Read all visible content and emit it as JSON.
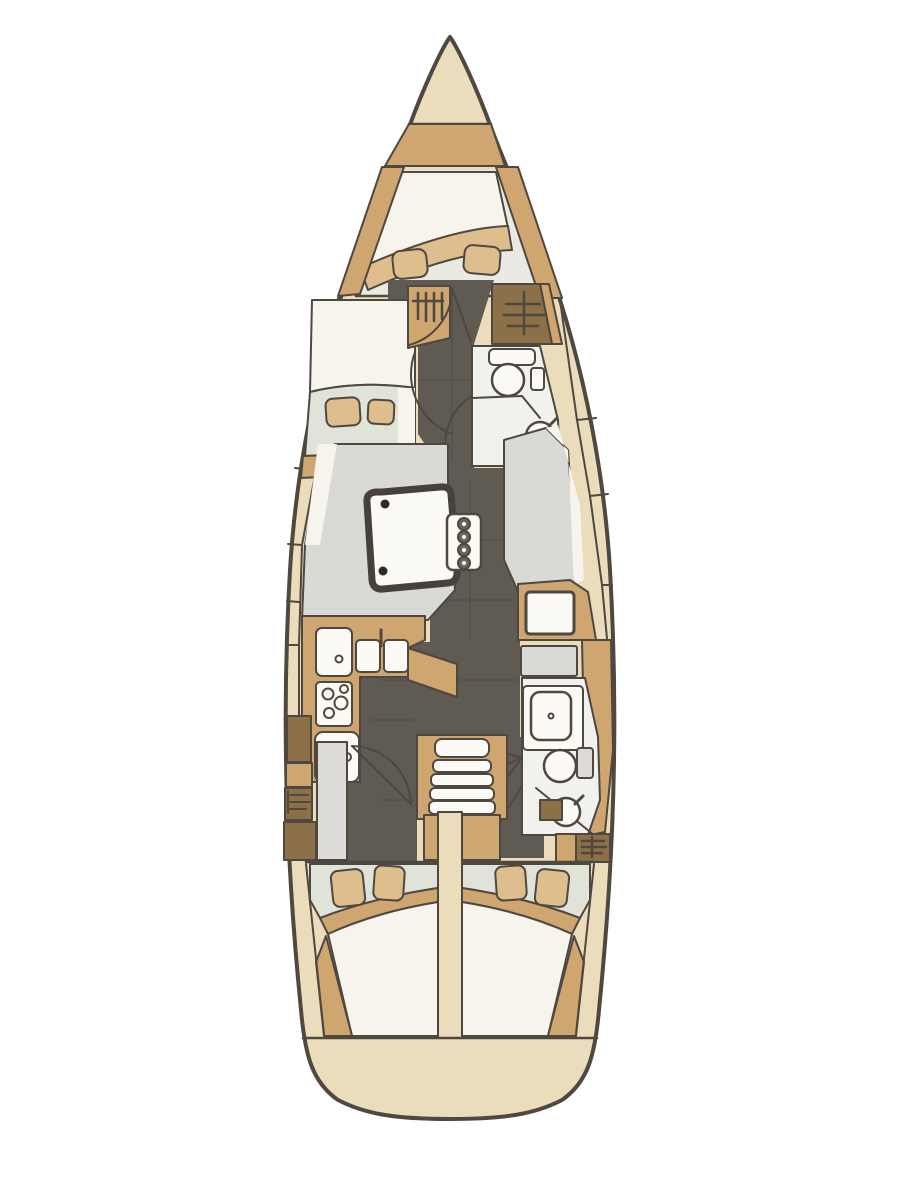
{
  "meta": {
    "app": "yacht-floor-plan",
    "description": "Top-down interior layout plan of a sailing yacht with bow V-berth cabin, forward port cabin, two heads, saloon with table, L-shaped galley, navigation station, companionway stairs and two mirrored aft double cabins",
    "canvas": {
      "width": 900,
      "height": 1200
    }
  },
  "colors": {
    "background": "#ffffff",
    "outline": "#4e4840",
    "table_border": "#46423b",
    "tile_line": "#2f2b26",
    "hull_cream": "#ebdcbc",
    "wood": "#cfa670",
    "wood_light": "#dfbe8d",
    "wood_dark": "#8c7048",
    "floor_dark": "#5f5a52",
    "floor_light": "#d9d9d5",
    "pale_green": "#e0e3d7",
    "cabin_floor": "#e8eae3",
    "berth_white": "#f6f4ec",
    "room_white": "#f1f1ed",
    "door_gray": "#dcdbd7",
    "fixture_white": "#fbfaf4",
    "dot_dark": "#2e2b27",
    "mast_ring": "#6b665e"
  },
  "features": {
    "bow": [
      "anchor-locker"
    ],
    "forward_cabin": [
      "v-berth",
      "pillow",
      "pillow",
      "foot-shelf-band"
    ],
    "port_cabin": [
      "berth",
      "pillow",
      "pillow"
    ],
    "corridor": [
      "hanging-locker-port",
      "hanging-locker-starboard",
      "door-swing-arcs"
    ],
    "forward_head": [
      "toilet-icon",
      "sink-icon",
      "faucet-icon"
    ],
    "salon": [
      "salon-table",
      "port-settee",
      "starboard-settee",
      "mast-post",
      "bottle-rack-icon"
    ],
    "galley": [
      "galley-sink-icon",
      "double-sink-icon",
      "faucet-icon",
      "stove-burners-icon",
      "fridge-icon"
    ],
    "nav_station": [
      "chart-table",
      "nav-seat"
    ],
    "companionway": [
      "stairs-icon",
      "engine-box"
    ],
    "aft_head": [
      "shower-icon",
      "toilet-icon",
      "sink-icon",
      "hanging-locker"
    ],
    "aft_cabins": [
      "port-berth",
      "starboard-berth",
      "pillows",
      "headboard-band"
    ],
    "stern": [
      "transom"
    ]
  }
}
